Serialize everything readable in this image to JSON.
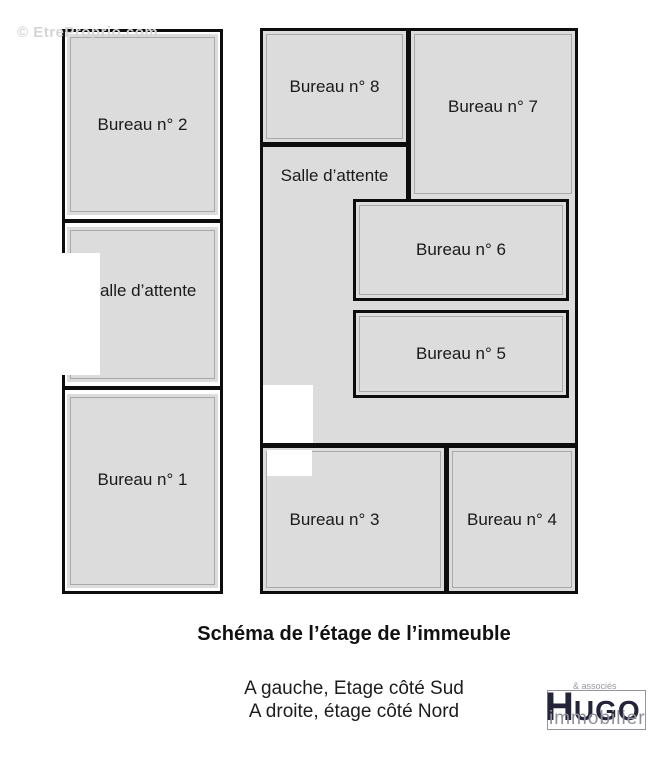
{
  "watermark": {
    "text": "© EtreProprio.com"
  },
  "plan": {
    "rooms": {
      "l_bureau2": "Bureau n° 2",
      "l_salle": "Salle d’attente",
      "l_bureau1": "Bureau n° 1",
      "r_bureau8": "Bureau n° 8",
      "r_bureau7": "Bureau n° 7",
      "r_salle": "Salle d’attente",
      "r_bureau6": "Bureau n° 6",
      "r_bureau5": "Bureau n° 5",
      "r_bureau3": "Bureau n° 3",
      "r_bureau4": "Bureau n° 4"
    }
  },
  "caption": {
    "title": "Schéma de l’étage de l’immeuble",
    "line1": "A gauche, Etage côté Sud",
    "line2": "A droite, étage côté Nord"
  },
  "logo": {
    "initial": "H",
    "rest": "UGO",
    "tagline": "& associés",
    "subtitle": "immobilier"
  },
  "colors": {
    "room_fill": "#dcdcdc",
    "wall": "#0d0d0d",
    "room_inner_line": "#a9a9a9",
    "logo_dark": "#23233a",
    "logo_gray": "#8f8f98",
    "watermark_gray": "#d5d5d5"
  }
}
